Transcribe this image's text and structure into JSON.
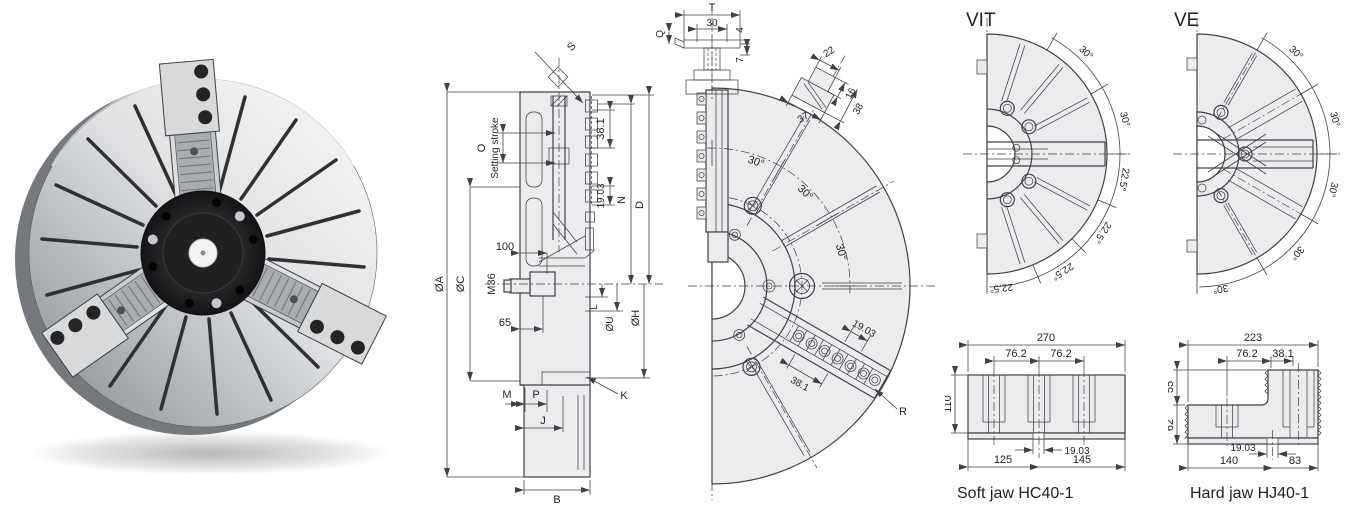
{
  "colors": {
    "line": "#3f4145",
    "fill": "#ebecee",
    "background": "#ffffff"
  },
  "section": {
    "s": "S",
    "o": "O",
    "stroke": "Setting stroke",
    "p38": "38.1",
    "p19": "19.03",
    "n": "N",
    "d": "D",
    "n100": "100",
    "m36": "M36",
    "n65": "65",
    "da": "ØA",
    "dc": "ØC",
    "l": "L",
    "du": "ØU",
    "dh": "ØH",
    "m": "M",
    "p": "P",
    "j": "J",
    "k": "K",
    "b": "B"
  },
  "front": {
    "t": "T",
    "n30": "30",
    "q": "Q",
    "n4": "4",
    "n7": "7",
    "n22": "22",
    "n37": "37",
    "n16": "16",
    "n38": "38",
    "angles": [
      "30°",
      "30°",
      "30°"
    ],
    "p19": "19.03",
    "p38": "38.1",
    "r": "R"
  },
  "vit": {
    "title": "VIT",
    "angles": [
      "30°",
      "30°",
      "22.5°",
      "22.5°",
      "22.5°",
      "22.5°"
    ]
  },
  "ve": {
    "title": "VE",
    "angles": [
      "30°",
      "30°",
      "30°",
      "30°",
      "30°"
    ]
  },
  "soft": {
    "caption": "Soft jaw HC40-1",
    "n270": "270",
    "a762": "76.2",
    "b762": "76.2",
    "n110": "110",
    "p19": "19.03",
    "n125": "125",
    "n145": "145"
  },
  "hard": {
    "caption": "Hard jaw HJ40-1",
    "n223": "223",
    "n762": "76.2",
    "n381": "38.1",
    "n55": "55",
    "n62": "62",
    "p19": "19.03",
    "n140": "140",
    "n83": "83"
  }
}
